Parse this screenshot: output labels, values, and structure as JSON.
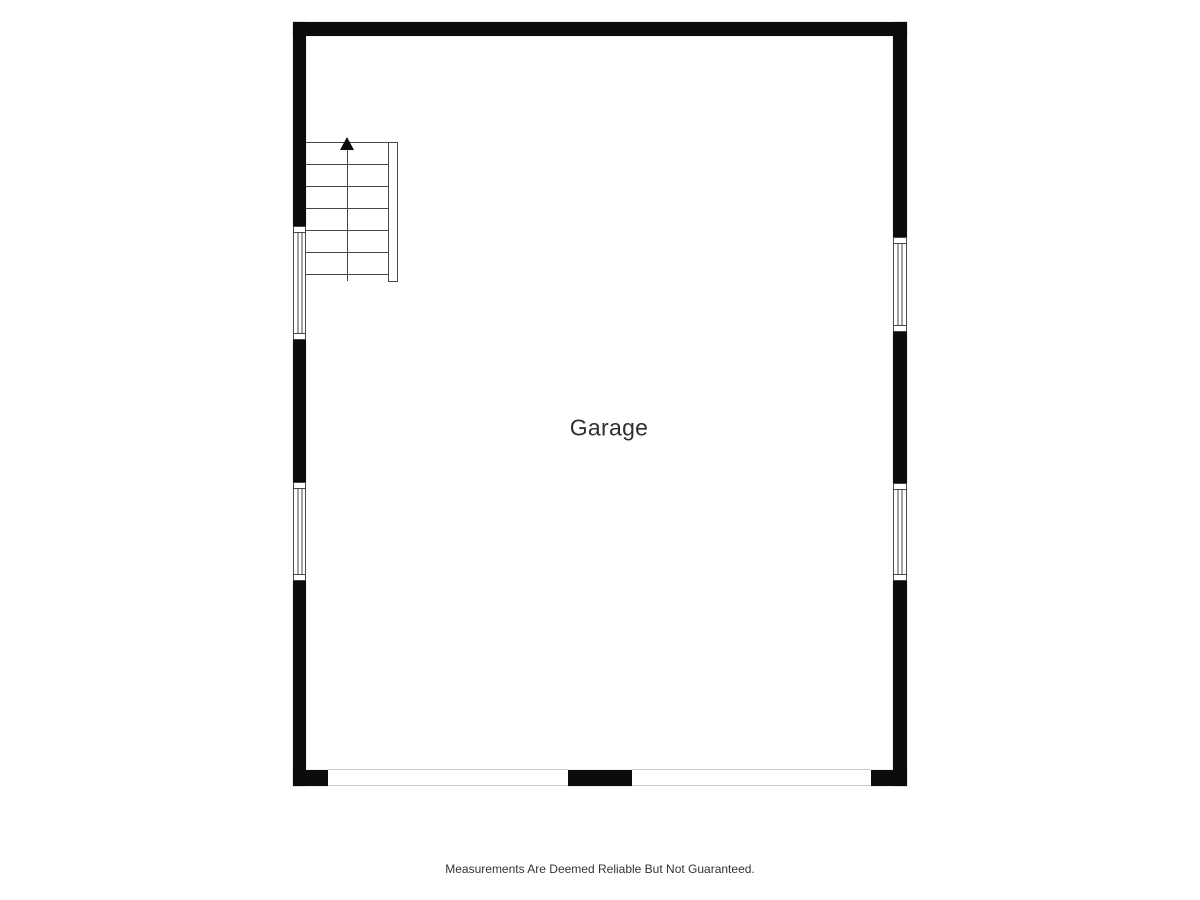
{
  "colors": {
    "wall": "#0c0c0c",
    "line": "#474747",
    "opening-line": "#cccccc",
    "label-text": "#303030",
    "background": "#ffffff"
  },
  "floorplan": {
    "room_label": "Garage",
    "stairs": {
      "steps": 6,
      "direction": "up",
      "arrow_icon": "up-arrow"
    },
    "features": {
      "windows": 4,
      "garage_door_openings": 2
    }
  },
  "footer": {
    "disclaimer": "Measurements Are Deemed Reliable But Not Guaranteed."
  }
}
